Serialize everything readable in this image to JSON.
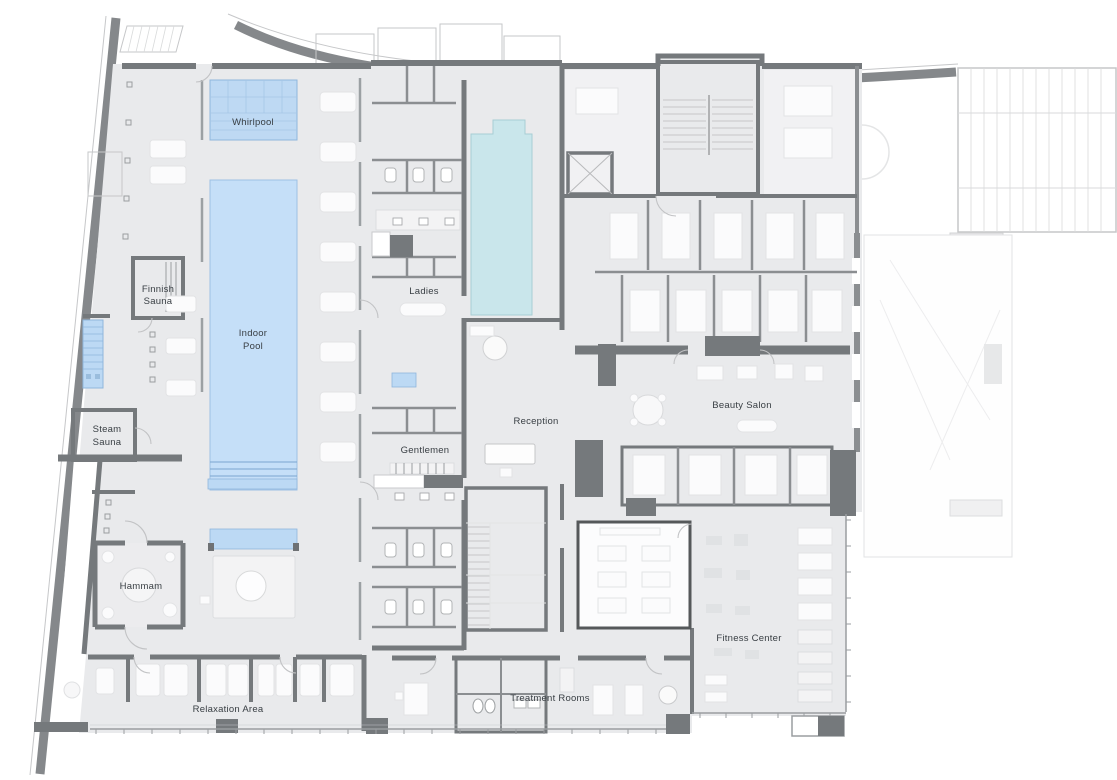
{
  "plan": {
    "rooms": {
      "whirlpool": "Whirlpool",
      "finnish_sauna": [
        "Finnish",
        "Sauna"
      ],
      "indoor_pool": [
        "Indoor",
        "Pool"
      ],
      "steam_sauna": [
        "Steam",
        "Sauna"
      ],
      "hammam": "Hammam",
      "relaxation_area": "Relaxation Area",
      "ladies": "Ladies",
      "gentlemen": "Gentlemen",
      "reception": "Reception",
      "beauty_salon": "Beauty Salon",
      "fitness_center": "Fitness Center",
      "treatment_rooms": "Treatment Rooms"
    },
    "colors": {
      "wall": "#75797c",
      "wall_dark": "#6e7174",
      "floor": "#e9eaec",
      "room_white": "#fbfbfc",
      "pool_blue": "#c5dff8",
      "whirlpool_blue": "#bed9f3",
      "pool_cyan": "#c9e6eb",
      "label_text": "#383e43"
    }
  }
}
